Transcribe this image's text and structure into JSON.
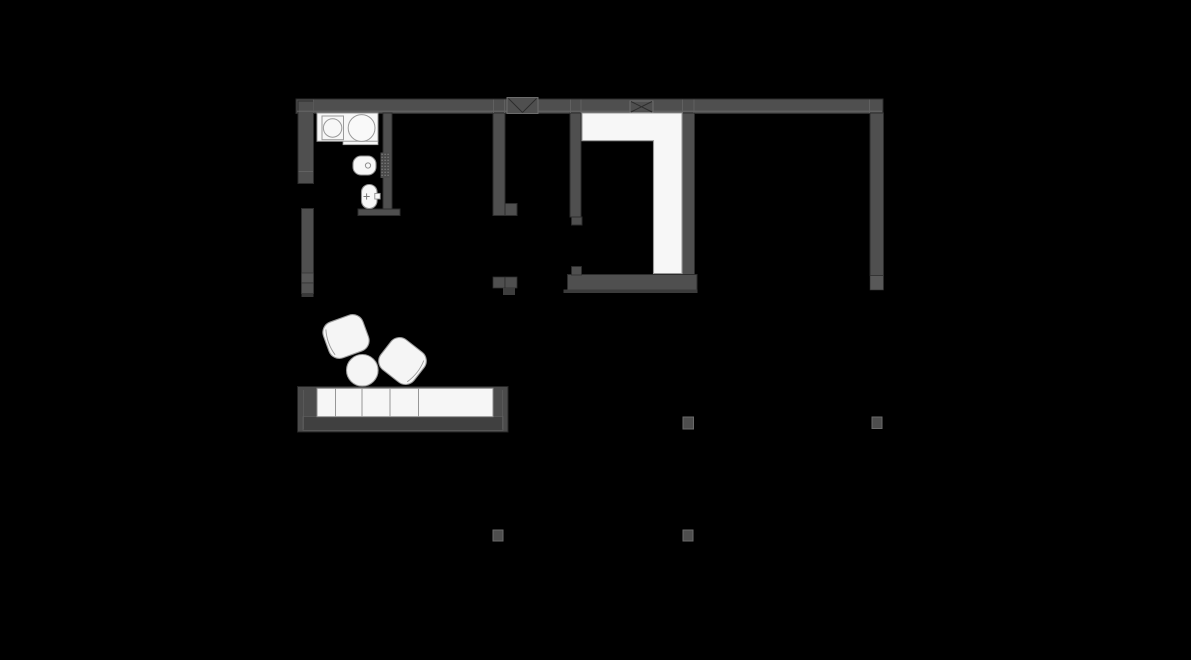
{
  "canvas": {
    "width": 1191,
    "height": 660,
    "background": "#000000"
  },
  "palette": {
    "background": "#000000",
    "wall_fill": "#4f4f4f",
    "wall_cap_fill": "#585858",
    "wall_outline": "#2c2c2c",
    "wall_highlight": "#6a6a6a",
    "fixture_white": "#f7f7f7",
    "fixture_stroke": "#949494",
    "furniture_white": "#f5f5f5",
    "furniture_stroke": "#9a9a9a",
    "sofa_frame": "#4b4b4b",
    "sofa_base": "#404040",
    "column_fill": "#4d4d4d",
    "column_stroke": "#6a6a6a"
  },
  "plan": {
    "shapes": [
      {
        "kind": "rect",
        "name": "top-exterior-wall",
        "x": 296,
        "y": 99,
        "w": 587,
        "h": 14.5,
        "fill": "#4f4f4f",
        "stroke": "#2c2c2c",
        "sw": 1
      },
      {
        "kind": "rect",
        "name": "left-exterior-wall-upper",
        "x": 298,
        "y": 101,
        "w": 15.5,
        "h": 82.5,
        "fill": "#4f4f4f",
        "stroke": "#2c2c2c",
        "sw": 1
      },
      {
        "kind": "rect",
        "name": "left-exterior-wall-lower",
        "x": 301.5,
        "y": 208.5,
        "w": 12,
        "h": 85,
        "fill": "#4f4f4f",
        "stroke": "#2c2c2c",
        "sw": 1
      },
      {
        "kind": "rect",
        "name": "left-wall-end-block-a",
        "x": 301.5,
        "y": 273,
        "w": 12,
        "h": 10,
        "fill": "#575757",
        "stroke": "#2c2c2c",
        "sw": 0.6
      },
      {
        "kind": "rect",
        "name": "left-wall-end-block-b",
        "x": 301.5,
        "y": 283,
        "w": 12,
        "h": 10.5,
        "fill": "#535353",
        "stroke": "#2c2c2c",
        "sw": 0.6
      },
      {
        "kind": "rect",
        "name": "left-wall-end-stub",
        "x": 301.5,
        "y": 293.5,
        "w": 12,
        "h": 3.5,
        "fill": "#393939"
      },
      {
        "kind": "rect",
        "name": "bathroom-partition-wall",
        "x": 383,
        "y": 113,
        "w": 9,
        "h": 102.5,
        "fill": "#4f4f4f",
        "stroke": "#2c2c2c",
        "sw": 1
      },
      {
        "kind": "rect",
        "name": "bathroom-south-wall",
        "x": 358,
        "y": 209,
        "w": 42,
        "h": 6.5,
        "fill": "#4f4f4f",
        "stroke": "#2c2c2c",
        "sw": 1
      },
      {
        "kind": "rect",
        "name": "hallway-left-wall",
        "x": 493,
        "y": 113,
        "w": 12,
        "h": 102.5,
        "fill": "#4f4f4f",
        "stroke": "#2c2c2c",
        "sw": 1
      },
      {
        "kind": "rect",
        "name": "hallway-left-wall-foot",
        "x": 505,
        "y": 203.5,
        "w": 12,
        "h": 12,
        "fill": "#4f4f4f",
        "stroke": "#2c2c2c",
        "sw": 1
      },
      {
        "kind": "rect",
        "name": "hallway-right-wall",
        "x": 570,
        "y": 113,
        "w": 11,
        "h": 104,
        "fill": "#4f4f4f",
        "stroke": "#2c2c2c",
        "sw": 1
      },
      {
        "kind": "rect",
        "name": "hallway-right-wall-foot",
        "x": 571.5,
        "y": 217,
        "w": 10.5,
        "h": 8,
        "fill": "#4f4f4f",
        "stroke": "#2c2c2c",
        "sw": 1
      },
      {
        "kind": "rect",
        "name": "wardrobe-room-right-wall",
        "x": 682,
        "y": 113,
        "w": 12.5,
        "h": 162.5,
        "fill": "#4f4f4f",
        "stroke": "#2c2c2c",
        "sw": 1
      },
      {
        "kind": "rect",
        "name": "wardrobe-room-right-wall-cap",
        "x": 682,
        "y": 275.5,
        "w": 13,
        "h": 14.5,
        "fill": "#585858",
        "stroke": "#2c2c2c",
        "sw": 0.6
      },
      {
        "kind": "rect",
        "name": "right-exterior-wall",
        "x": 870,
        "y": 113,
        "w": 13.5,
        "h": 162.5,
        "fill": "#4f4f4f",
        "stroke": "#2c2c2c",
        "sw": 1
      },
      {
        "kind": "rect",
        "name": "right-exterior-wall-cap",
        "x": 870,
        "y": 275.5,
        "w": 13.5,
        "h": 14.5,
        "fill": "#585858",
        "stroke": "#2c2c2c",
        "sw": 0.6
      },
      {
        "kind": "rect",
        "name": "wardrobe-room-bottom-wall",
        "x": 567.5,
        "y": 274.5,
        "w": 129.5,
        "h": 15.5,
        "fill": "#4f4f4f",
        "stroke": "#2c2c2c",
        "sw": 1
      },
      {
        "kind": "rect",
        "name": "wardrobe-room-bottom-lip",
        "x": 563.5,
        "y": 289.5,
        "w": 134,
        "h": 3.5,
        "fill": "#3b3b3b"
      },
      {
        "kind": "rect",
        "name": "wardrobe-room-wall-knob",
        "x": 571.5,
        "y": 266.5,
        "w": 10,
        "h": 8.5,
        "fill": "#4f4f4f",
        "stroke": "#2c2c2c",
        "sw": 0.8
      },
      {
        "kind": "rect",
        "name": "hallway-end-block-a",
        "x": 493,
        "y": 277,
        "w": 12,
        "h": 11,
        "fill": "#4f4f4f",
        "stroke": "#2c2c2c",
        "sw": 0.8
      },
      {
        "kind": "rect",
        "name": "hallway-end-block-b",
        "x": 505,
        "y": 277,
        "w": 12,
        "h": 11,
        "fill": "#4f4f4f",
        "stroke": "#2c2c2c",
        "sw": 0.8
      },
      {
        "kind": "rect",
        "name": "hallway-end-tab",
        "x": 503,
        "y": 288,
        "w": 12,
        "h": 7,
        "fill": "#3d3d3d"
      },
      {
        "kind": "line",
        "name": "top-wall-inner-line",
        "x1": 297,
        "y1": 111.2,
        "x2": 882,
        "y2": 111.2,
        "stroke": "#6a6a6a",
        "sw": 0.9
      },
      {
        "kind": "line",
        "name": "top-wall-junction-line-1",
        "x1": 313.5,
        "y1": 99.5,
        "x2": 313.5,
        "y2": 113,
        "stroke": "#646464",
        "sw": 0.8
      },
      {
        "kind": "line",
        "name": "top-wall-junction-line-2",
        "x1": 493.5,
        "y1": 99.5,
        "x2": 493.5,
        "y2": 113,
        "stroke": "#646464",
        "sw": 0.8
      },
      {
        "kind": "line",
        "name": "top-wall-junction-line-3",
        "x1": 504.5,
        "y1": 99.5,
        "x2": 504.5,
        "y2": 113,
        "stroke": "#646464",
        "sw": 0.8
      },
      {
        "kind": "line",
        "name": "top-wall-junction-line-4",
        "x1": 570.5,
        "y1": 99.5,
        "x2": 570.5,
        "y2": 113,
        "stroke": "#646464",
        "sw": 0.8
      },
      {
        "kind": "line",
        "name": "top-wall-junction-line-5",
        "x1": 581,
        "y1": 99.5,
        "x2": 581,
        "y2": 113,
        "stroke": "#646464",
        "sw": 0.8
      },
      {
        "kind": "line",
        "name": "top-wall-junction-line-6",
        "x1": 682.5,
        "y1": 99.5,
        "x2": 682.5,
        "y2": 113,
        "stroke": "#646464",
        "sw": 0.8
      },
      {
        "kind": "line",
        "name": "top-wall-junction-line-7",
        "x1": 694,
        "y1": 99.5,
        "x2": 694,
        "y2": 113,
        "stroke": "#646464",
        "sw": 0.8
      },
      {
        "kind": "line",
        "name": "top-wall-junction-line-8",
        "x1": 869.5,
        "y1": 99.5,
        "x2": 869.5,
        "y2": 113,
        "stroke": "#646464",
        "sw": 0.8
      },
      {
        "kind": "line",
        "name": "left-wall-cap-line",
        "x1": 298.5,
        "y1": 171.5,
        "x2": 313,
        "y2": 171.5,
        "stroke": "#646464",
        "sw": 0.9
      },
      {
        "kind": "rect",
        "name": "vent-shaft-box-1",
        "x": 507,
        "y": 97.5,
        "w": 31,
        "h": 16,
        "fill": "#4f4f4f",
        "stroke": "#6c6c6c",
        "sw": 1
      },
      {
        "kind": "line",
        "name": "vent-shaft-1-diagonal-a",
        "x1": 508.5,
        "y1": 98.5,
        "x2": 522.5,
        "y2": 112.5,
        "stroke": "#2c2c2c",
        "sw": 1
      },
      {
        "kind": "line",
        "name": "vent-shaft-1-diagonal-b",
        "x1": 536.5,
        "y1": 98.5,
        "x2": 522.5,
        "y2": 112.5,
        "stroke": "#2c2c2c",
        "sw": 1
      },
      {
        "kind": "rect",
        "name": "vent-shaft-box-2",
        "x": 630,
        "y": 101,
        "w": 23,
        "h": 11.5,
        "fill": "#4f4f4f",
        "stroke": "#6c6c6c",
        "sw": 1
      },
      {
        "kind": "line",
        "name": "vent-shaft-2-diagonal-a",
        "x1": 631,
        "y1": 101.5,
        "x2": 652,
        "y2": 112,
        "stroke": "#2c2c2c",
        "sw": 1
      },
      {
        "kind": "line",
        "name": "vent-shaft-2-diagonal-b",
        "x1": 652,
        "y1": 101.5,
        "x2": 631,
        "y2": 112,
        "stroke": "#2c2c2c",
        "sw": 1
      },
      {
        "kind": "path",
        "name": "wardrobe-unit",
        "d": "M582,113 L682,113 L682,273.5 L653.5,273.5 L653.5,140.7 L582,140.7 Z",
        "fill": "#f7f7f7",
        "stroke": "#9a9a9a",
        "sw": 1.1
      },
      {
        "kind": "rect",
        "name": "bathroom-counter",
        "x": 317,
        "y": 113,
        "w": 61,
        "h": 28.3,
        "fill": "#f7f7f7",
        "stroke": "#949494",
        "sw": 1
      },
      {
        "kind": "rect",
        "name": "bathroom-counter-step",
        "x": 343,
        "y": 141.3,
        "w": 35,
        "h": 3.4,
        "fill": "#f7f7f7",
        "stroke": "#949494",
        "sw": 0.8
      },
      {
        "kind": "rect",
        "name": "washing-machine",
        "x": 322,
        "y": 116,
        "w": 21.5,
        "h": 23.7,
        "fill": "none",
        "stroke": "#9a9a9a",
        "sw": 1
      },
      {
        "kind": "circle",
        "name": "washing-machine-drum",
        "cx": 332.6,
        "cy": 128,
        "r": 9.2,
        "fill": "none",
        "stroke": "#9a9a9a",
        "sw": 1
      },
      {
        "kind": "circle",
        "name": "washbasin",
        "cx": 361.6,
        "cy": 128,
        "r": 13.4,
        "fill": "#f9f9f9",
        "stroke": "#9a9a9a",
        "sw": 1
      },
      {
        "kind": "dotgrid",
        "name": "tiled-strip",
        "x": 380.5,
        "y": 152.5,
        "w": 9,
        "h": 25.5,
        "fill": "#4a4a4a",
        "dot": "#8a8a8a"
      },
      {
        "kind": "rect",
        "name": "toilet",
        "x": 353,
        "y": 156,
        "w": 23,
        "h": 19,
        "rx": 8,
        "fill": "#f7f7f7",
        "stroke": "#8f8f8f",
        "sw": 1.1
      },
      {
        "kind": "circle",
        "name": "toilet-flush-button",
        "cx": 368,
        "cy": 165.5,
        "r": 2.6,
        "fill": "none",
        "stroke": "#8f8f8f",
        "sw": 1
      },
      {
        "kind": "rect",
        "name": "bidet",
        "x": 361.5,
        "y": 184.5,
        "w": 15.5,
        "h": 24,
        "rx": 7.5,
        "fill": "#f7f7f7",
        "stroke": "#8f8f8f",
        "sw": 1.1
      },
      {
        "kind": "rect",
        "name": "bidet-faucet",
        "x": 374.8,
        "y": 193.4,
        "w": 5.4,
        "h": 5.6,
        "fill": "#f7f7f7",
        "stroke": "#8f8f8f",
        "sw": 0.9
      },
      {
        "kind": "line",
        "name": "bidet-cross-h",
        "x1": 363.5,
        "y1": 196.5,
        "x2": 369.7,
        "y2": 196.5,
        "stroke": "#787878",
        "sw": 1
      },
      {
        "kind": "line",
        "name": "bidet-cross-v",
        "x1": 366.6,
        "y1": 193.4,
        "x2": 366.6,
        "y2": 199.6,
        "stroke": "#787878",
        "sw": 1
      },
      {
        "kind": "rect",
        "name": "sofa-frame",
        "x": 297.5,
        "y": 386.5,
        "w": 210.5,
        "h": 45.5,
        "fill": "#4b4b4b",
        "stroke": "#242424",
        "sw": 1
      },
      {
        "kind": "rect",
        "name": "sofa-base",
        "x": 303,
        "y": 416.5,
        "w": 200,
        "h": 14,
        "fill": "#404040",
        "stroke": "#5e5e5e",
        "sw": 0.7
      },
      {
        "kind": "line",
        "name": "sofa-armrest-line-left",
        "x1": 303.5,
        "y1": 390,
        "x2": 303.5,
        "y2": 429.5,
        "stroke": "#5e5e5e",
        "sw": 0.7
      },
      {
        "kind": "line",
        "name": "sofa-armrest-line-right",
        "x1": 502.5,
        "y1": 390,
        "x2": 502.5,
        "y2": 429.5,
        "stroke": "#5e5e5e",
        "sw": 0.7
      },
      {
        "kind": "rect",
        "name": "sofa-cushions",
        "x": 317,
        "y": 388.3,
        "w": 176,
        "h": 28.4,
        "fill": "#f6f6f6",
        "stroke": "#8d8d8d",
        "sw": 1
      },
      {
        "kind": "line",
        "name": "sofa-cushion-divider-1",
        "x1": 335.5,
        "y1": 388.8,
        "x2": 335.5,
        "y2": 416.3,
        "stroke": "#8d8d8d",
        "sw": 0.9
      },
      {
        "kind": "line",
        "name": "sofa-cushion-divider-2",
        "x1": 362,
        "y1": 388.8,
        "x2": 362,
        "y2": 416.3,
        "stroke": "#8d8d8d",
        "sw": 0.9
      },
      {
        "kind": "line",
        "name": "sofa-cushion-divider-3",
        "x1": 390,
        "y1": 388.8,
        "x2": 390,
        "y2": 416.3,
        "stroke": "#8d8d8d",
        "sw": 0.9
      },
      {
        "kind": "line",
        "name": "sofa-cushion-divider-4",
        "x1": 418.5,
        "y1": 388.8,
        "x2": 418.5,
        "y2": 416.3,
        "stroke": "#8d8d8d",
        "sw": 0.9
      },
      {
        "kind": "rect",
        "name": "armchair-1",
        "x": -21,
        "y": -19,
        "w": 42,
        "h": 38,
        "rx": 11,
        "t": "translate(346,336.5) rotate(-20)",
        "fill": "#f5f5f5",
        "stroke": "#9a9a9a",
        "sw": 1.1
      },
      {
        "kind": "path",
        "name": "armchair-1-back-line",
        "d": "M -16.5 -13.5 Q -20.5 0 -16.5 13.5",
        "t": "translate(346,336.5) rotate(-20)",
        "fill": "none",
        "stroke": "#9a9a9a",
        "sw": 0.9
      },
      {
        "kind": "rect",
        "name": "armchair-2",
        "x": -21,
        "y": -19,
        "w": 42,
        "h": 38,
        "rx": 11,
        "t": "translate(402.5,361) rotate(38)",
        "fill": "#f5f5f5",
        "stroke": "#9a9a9a",
        "sw": 1.1
      },
      {
        "kind": "path",
        "name": "armchair-2-back-line",
        "d": "M 16.5 -13.5 Q 20.5 0 16.5 13.5",
        "t": "translate(402.5,361) rotate(38)",
        "fill": "none",
        "stroke": "#9a9a9a",
        "sw": 0.9
      },
      {
        "kind": "circle",
        "name": "coffee-table",
        "cx": 362.3,
        "cy": 370.3,
        "r": 15.8,
        "fill": "#f5f5f5",
        "stroke": "#9a9a9a",
        "sw": 1.1
      },
      {
        "kind": "rect",
        "name": "column-sw",
        "x": 493,
        "y": 530,
        "w": 10,
        "h": 11,
        "fill": "#4d4d4d",
        "stroke": "#6a6a6a",
        "sw": 1
      },
      {
        "kind": "rect",
        "name": "column-s",
        "x": 683,
        "y": 530,
        "w": 10,
        "h": 11,
        "fill": "#4d4d4d",
        "stroke": "#6a6a6a",
        "sw": 1
      },
      {
        "kind": "rect",
        "name": "column-mid",
        "x": 683,
        "y": 417,
        "w": 10.5,
        "h": 12,
        "fill": "#4d4d4d",
        "stroke": "#6a6a6a",
        "sw": 1
      },
      {
        "kind": "rect",
        "name": "column-e",
        "x": 872,
        "y": 417,
        "w": 10,
        "h": 11.5,
        "fill": "#4d4d4d",
        "stroke": "#6a6a6a",
        "sw": 1
      }
    ]
  }
}
